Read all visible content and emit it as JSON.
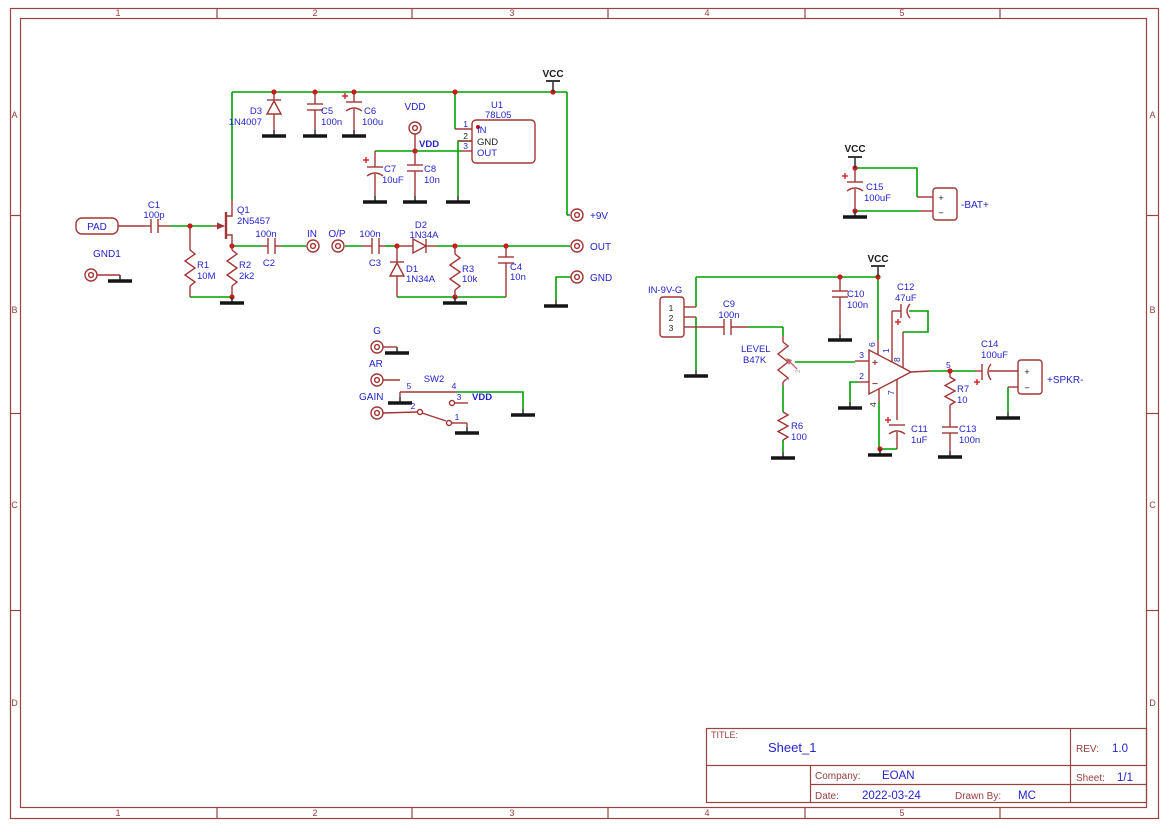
{
  "frame": {
    "columns": [
      "1",
      "2",
      "3",
      "4",
      "5"
    ],
    "rows": [
      "A",
      "B",
      "C",
      "D"
    ]
  },
  "title_block": {
    "title_label": "TITLE:",
    "title": "Sheet_1",
    "rev_label": "REV:",
    "rev": "1.0",
    "company_label": "Company:",
    "company": "EOAN",
    "sheet_label": "Sheet:",
    "sheet": "1/1",
    "date_label": "Date:",
    "date": "2022-03-24",
    "drawn_by_label": "Drawn By:",
    "drawn_by": "MC"
  },
  "power": {
    "vcc": "VCC",
    "vdd": "VDD"
  },
  "marks": {
    "plus": "+",
    "minus": "−"
  },
  "ports": {
    "pad": "PAD",
    "gnd1": "GND1",
    "in": "IN",
    "op": "O/P",
    "out": "OUT",
    "gnd": "GND",
    "p9v": "+9V",
    "g": "G",
    "ar": "AR",
    "gain": "GAIN"
  },
  "connectors": {
    "bat": {
      "label": "-BAT+"
    },
    "spkr": {
      "label": "+SPKR-"
    },
    "in9vg": {
      "label": "IN-9V-G",
      "pins": [
        "1",
        "2",
        "3"
      ]
    }
  },
  "components": {
    "c1": {
      "ref": "C1",
      "val": "100p"
    },
    "c2": {
      "ref": "C2",
      "val": "100n"
    },
    "c3": {
      "ref": "C3",
      "val": "100n"
    },
    "c4": {
      "ref": "C4",
      "val": "10n"
    },
    "c5": {
      "ref": "C5",
      "val": "100n"
    },
    "c6": {
      "ref": "C6",
      "val": "100u"
    },
    "c7": {
      "ref": "C7",
      "val": "10uF"
    },
    "c8": {
      "ref": "C8",
      "val": "10n"
    },
    "c9": {
      "ref": "C9",
      "val": "100n"
    },
    "c10": {
      "ref": "C10",
      "val": "100n"
    },
    "c11": {
      "ref": "C11",
      "val": "1uF"
    },
    "c12": {
      "ref": "C12",
      "val": "47uF"
    },
    "c13": {
      "ref": "C13",
      "val": "100n"
    },
    "c14": {
      "ref": "C14",
      "val": "100uF"
    },
    "c15": {
      "ref": "C15",
      "val": "100uF"
    },
    "r1": {
      "ref": "R1",
      "val": "10M"
    },
    "r2": {
      "ref": "R2",
      "val": "2k2"
    },
    "r3": {
      "ref": "R3",
      "val": "10k"
    },
    "r6": {
      "ref": "R6",
      "val": "100"
    },
    "r7": {
      "ref": "R7",
      "val": "10"
    },
    "d1": {
      "ref": "D1",
      "val": "1N34A"
    },
    "d2": {
      "ref": "D2",
      "val": "1N34A"
    },
    "d3": {
      "ref": "D3",
      "val": "1N4007"
    },
    "q1": {
      "ref": "Q1",
      "val": "2N5457"
    },
    "u1": {
      "ref": "U1",
      "val": "78L05",
      "pins": [
        "1",
        "2",
        "3"
      ],
      "pin_names": [
        "IN",
        "GND",
        "OUT"
      ]
    },
    "sw2": {
      "ref": "SW2",
      "pin1": "1",
      "pin2": "2",
      "pin3": "3",
      "pin4": "4",
      "pin5": "5"
    },
    "pot": {
      "ref": "LEVEL",
      "val": "B47K",
      "pins": [
        "1",
        "2",
        "3"
      ]
    },
    "opamp": {
      "p1": "1",
      "p2": "2",
      "p3": "3",
      "p4": "4",
      "p5": "5",
      "p6": "6",
      "p7": "7",
      "p8": "8"
    }
  }
}
